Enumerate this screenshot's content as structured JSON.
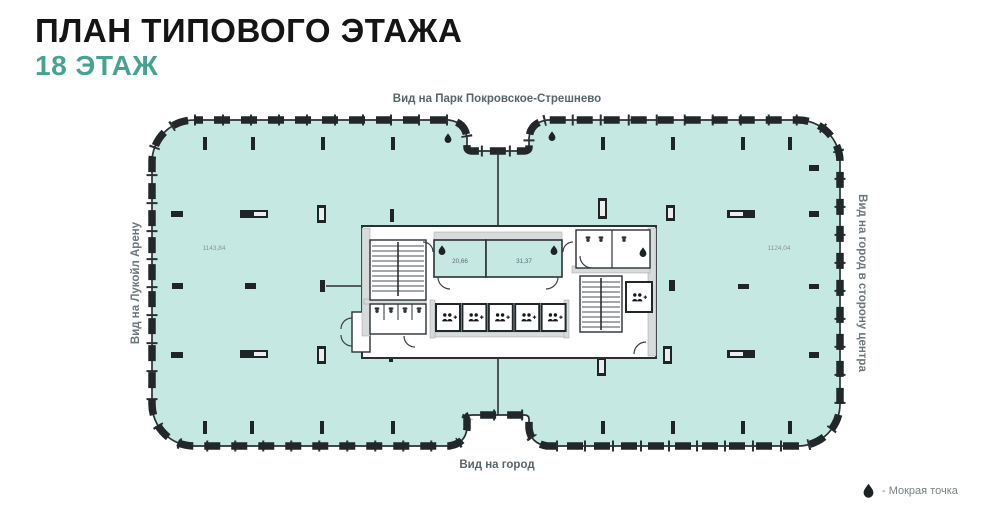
{
  "header": {
    "title": "ПЛАН ТИПОВОГО ЭТАЖА",
    "subtitle": "18 ЭТАЖ"
  },
  "plan": {
    "view_labels": {
      "top": "Вид на Парк Покровское-Стрешнево",
      "bottom": "Вид на город",
      "left": "Вид на Лукойл Арену",
      "right": "Вид на город в сторону центра"
    },
    "open_areas": {
      "left": "1143,84",
      "right": "1124,04"
    },
    "wet_rooms": {
      "left": "20,66",
      "right": "31,37"
    },
    "colors": {
      "floor_fill": "#c6e8e2",
      "accent": "#46a392",
      "wall": "#2b3133"
    },
    "icons": {
      "wet_point": "water-drop-icon",
      "elevator_capacity": "people-plus-icon"
    }
  },
  "legend": {
    "wet_point_label": "- Мокрая точка"
  }
}
